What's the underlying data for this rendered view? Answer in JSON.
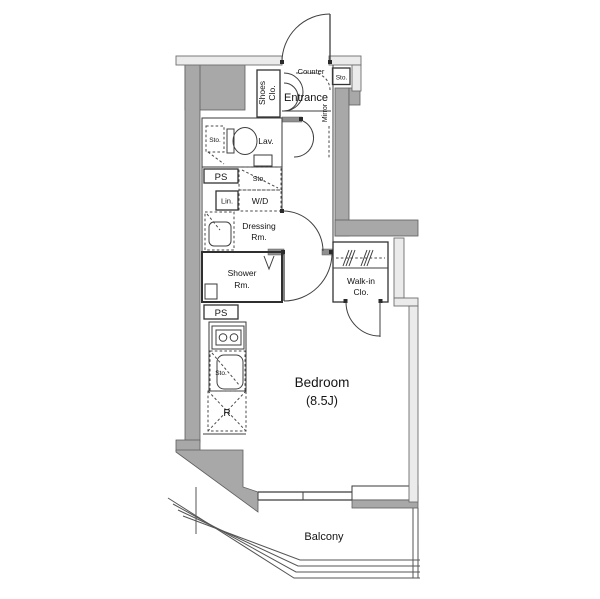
{
  "plan": {
    "type": "apartment-floor-plan",
    "labels": {
      "counter": "Counter",
      "sto_top": "Sto.",
      "shoes_1": "Shoes",
      "shoes_2": "Clo.",
      "entrance": "Entrance",
      "mirror": "Mirror",
      "sto_lav": "Sto.",
      "lav": "Lav.",
      "ps_upper": "PS",
      "sto_wd": "Sto.",
      "wd": "W/D",
      "lin": "Lin.",
      "dressing_1": "Dressing",
      "dressing_2": "Rm.",
      "shower_1": "Shower",
      "shower_2": "Rm.",
      "walkin_1": "Walk-in",
      "walkin_2": "Clo.",
      "ps_lower": "PS",
      "sto_kitchen": "Sto.",
      "fridge": "R",
      "bedroom_name": "Bedroom",
      "bedroom_size": "(8.5J)",
      "balcony": "Balcony"
    },
    "colors": {
      "wall": "#a8a8a8",
      "wall_light": "#ebebeb",
      "line": "#3f3f3f",
      "background": "#ffffff"
    }
  }
}
